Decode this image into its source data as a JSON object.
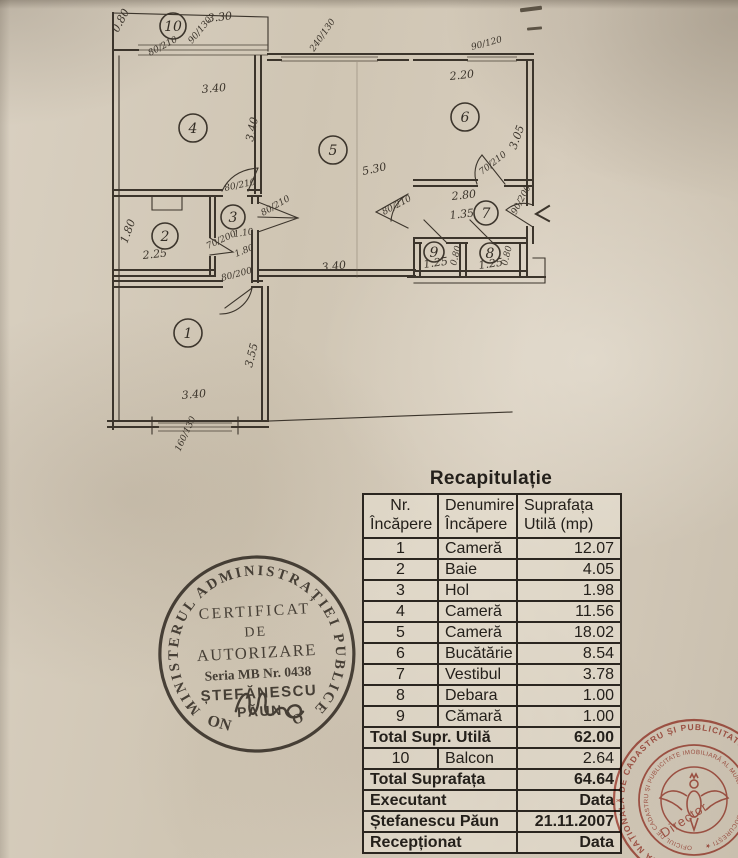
{
  "plan": {
    "rooms": [
      "1",
      "2",
      "3",
      "4",
      "5",
      "6",
      "7",
      "8",
      "9",
      "10"
    ],
    "labels": {
      "corner_height": "0.80",
      "balcony_width": "3.30",
      "balcony_door": "80/210",
      "balcony_window": "90/130",
      "room4_width": "3.40",
      "room4_height": "3.40",
      "window_mid": "240/130",
      "room5_height": "5.30",
      "room6_window": "90/120",
      "room6_width": "2.20",
      "room6_height": "3.05",
      "room6_door": "70/210",
      "room7_width": "2.80",
      "room7_depth": "1.35",
      "entry_door": "90/200",
      "room5_door": "80/210",
      "room9_height": "0.80",
      "room8_height": "0.80",
      "room9_width": "1.25",
      "room8_width": "1.25",
      "room2_height": "1.80",
      "room2_width": "2.25",
      "room2_door": "70/200",
      "room3_door_top": "80/210",
      "room3_door_side": "80/210",
      "room3_width": "1.10",
      "room3_height": "1.80",
      "room1_door": "80/200",
      "room5_width": "3.40",
      "room1_height": "3.55",
      "room1_width": "3.40",
      "room1_window": "160/130"
    }
  },
  "table": {
    "title": "Recapitulație",
    "headers": {
      "col1_line1": "Nr.",
      "col1_line2": "Încăpere",
      "col2_line1": "Denumire",
      "col2_line2": "Încăpere",
      "col3_line1": "Suprafața",
      "col3_line2": "Utilă (mp)"
    },
    "rows": [
      {
        "nr": "1",
        "name": "Cameră",
        "area": "12.07"
      },
      {
        "nr": "2",
        "name": "Baie",
        "area": "4.05"
      },
      {
        "nr": "3",
        "name": "Hol",
        "area": "1.98"
      },
      {
        "nr": "4",
        "name": "Cameră",
        "area": "11.56"
      },
      {
        "nr": "5",
        "name": "Cameră",
        "area": "18.02"
      },
      {
        "nr": "6",
        "name": "Bucătărie",
        "area": "8.54"
      },
      {
        "nr": "7",
        "name": "Vestibul",
        "area": "3.78"
      },
      {
        "nr": "8",
        "name": "Debara",
        "area": "1.00"
      },
      {
        "nr": "9",
        "name": "Cămară",
        "area": "1.00"
      }
    ],
    "total_util_label": "Total Supr. Utilă",
    "total_util_value": "62.00",
    "balcony_row": {
      "nr": "10",
      "name": "Balcon",
      "area": "2.64"
    },
    "total_label": "Total Suprafața",
    "total_value": "64.64",
    "executant_label": "Executant",
    "executant_data": "Data",
    "executant_name": "Ștefanescu Păun",
    "executant_date": "21.11.2007",
    "receptionat_label": "Recepționat",
    "receptionat_data": "Data"
  },
  "stamps": {
    "round": {
      "ring_text": "MINISTERUL  ADMINISTRAȚIEI  PUBLICE",
      "bottom_left": "ON",
      "bottom_right": "O",
      "line1": "CERTIFICAT",
      "line2": "DE",
      "line3": "AUTORIZARE",
      "line4": "Seria MB Nr. 0438",
      "line5": "ȘTEFĂNESCU",
      "line6": "PĂUN",
      "ink_color": "#36302a"
    },
    "red": {
      "outer_ring": "AGENȚIA NAȚIONALĂ DE CADASTRU ȘI PUBLICITATE IMOBILIARĂ ★",
      "inner_ring": "OFICIUL DE CADASTRU ȘI PUBLICITATE IMOBILIARĂ AL MUNICIPIULUI BUCUREȘTI ★",
      "center_text": "Director",
      "ink_color": "#b3483c"
    }
  }
}
